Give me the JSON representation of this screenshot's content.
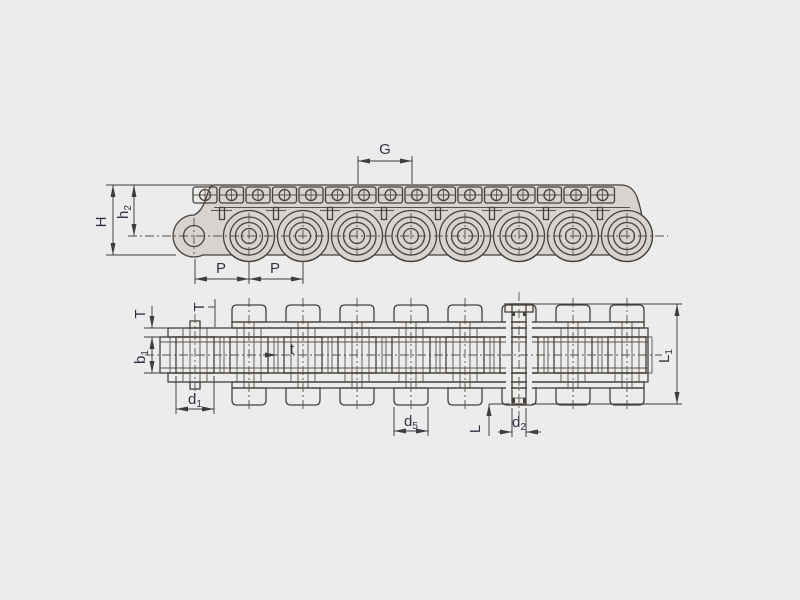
{
  "drawing_title": "roller-chain-with-attachments-dimension-diagram",
  "colors": {
    "bg": "#ececec",
    "metal_fill": "#d6d3d1",
    "light_fill": "#f0efee",
    "tab_fill": "#eceae9",
    "outline": "#47403a",
    "dim_line": "#3c3c42",
    "label_text": "#2d3340"
  },
  "labels": {
    "G": {
      "base": "G",
      "sub": ""
    },
    "H": {
      "base": "H",
      "sub": ""
    },
    "h2": {
      "base": "h",
      "sub": "2"
    },
    "P1": {
      "base": "P",
      "sub": ""
    },
    "P2": {
      "base": "P",
      "sub": ""
    },
    "T1": {
      "base": "T",
      "sub": ""
    },
    "T2": {
      "base": "T",
      "sub": ""
    },
    "b1": {
      "base": "b",
      "sub": "1"
    },
    "d1": {
      "base": "d",
      "sub": "1"
    },
    "t": {
      "base": "t",
      "sub": ""
    },
    "d5": {
      "base": "d",
      "sub": "5"
    },
    "L": {
      "base": "L",
      "sub": ""
    },
    "d2": {
      "base": "d",
      "sub": "2"
    },
    "L1": {
      "base": "L",
      "sub": "1"
    }
  },
  "chain": {
    "pin_start_x": 195,
    "pitch": 54,
    "pin_count": 9,
    "side": {
      "centerline_y": 236,
      "top_y": 185,
      "bottom_y": 255,
      "roller_r": 19,
      "ring_r": 13.5,
      "pin_r": 7.5,
      "contour_r": 25.5,
      "endpin_hole_r": 10.5,
      "endpin_lobe_r": 21,
      "tab_start_cx": 205,
      "tab_pitch": 26.5,
      "tab_count": 16,
      "tab_w": 24,
      "tab_top_y": 187,
      "tab_h": 16,
      "hole_r": 5.5,
      "hole_cy": 195,
      "plate_line_y": 207.5,
      "slot_start_x": 222,
      "slot_pitch": 54,
      "slot_count": 8,
      "slot_w": 5,
      "slot_top_y": 207.5,
      "slot_h": 12
    },
    "plan": {
      "centerline_y": 355,
      "inner_top": 337,
      "inner_bot": 373,
      "outer_top": 328,
      "outer_bot": 382,
      "attach_top": 322,
      "attach_bot": 388,
      "tab_out_top": 305,
      "tab_out_bot": 405,
      "tab_half_w": 17,
      "left_x": 160,
      "right_x": 648,
      "strip_left_x": 168,
      "attach_left": 232,
      "attach_right": 644,
      "roller_half": 19,
      "bush_half": 12,
      "pin_half": 5,
      "white_half_out": 25,
      "inner_line1": 342,
      "inner_line2": 368,
      "tab_pins": [
        249,
        303,
        357,
        411,
        465,
        519,
        573,
        627
      ],
      "ext_pin_cx": 519,
      "ext_pin_half": 7,
      "ext_pin_top": 304,
      "ext_pin_bot": 404,
      "ext_cap_x": 505,
      "ext_cap_w": 28,
      "ext_cap_h": 8
    }
  }
}
